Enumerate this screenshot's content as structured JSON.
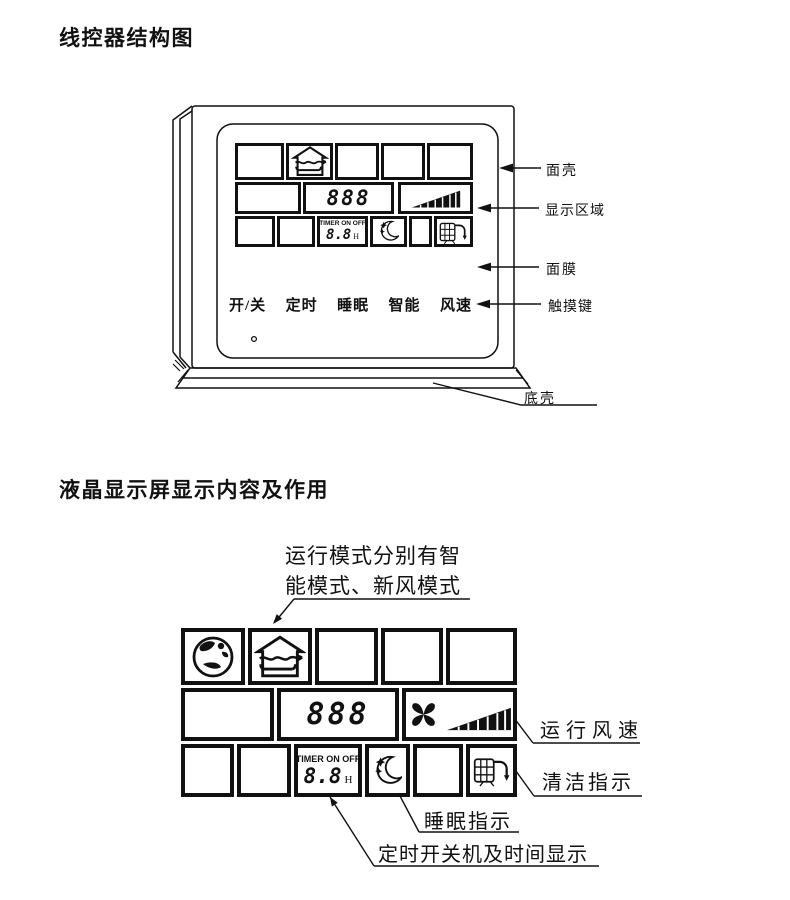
{
  "colors": {
    "ink": "#111111",
    "background": "#ffffff"
  },
  "section1": {
    "title": "线控器结构图",
    "touch_keys": [
      "开/关",
      "定时",
      "睡眠",
      "智能",
      "风速"
    ],
    "callouts": {
      "front_shell": "面壳",
      "display_area": "显示区域",
      "face_film": "面膜",
      "touch_keys": "触摸键",
      "bottom_shell": "底壳"
    },
    "display": {
      "temp_digits": "888",
      "timer_caption": "TIMER ON OFF",
      "timer_value": "8.8",
      "timer_unit": "H"
    }
  },
  "section2": {
    "title": "液晶显示屏显示内容及作用",
    "mode_note": {
      "line1": "运行模式分别有智",
      "line2": "能模式、新风模式"
    },
    "display": {
      "temp_digits": "888",
      "timer_caption": "TIMER ON OFF",
      "timer_value": "8.8",
      "timer_unit": "H"
    },
    "callouts": {
      "fan_speed": "运行风速",
      "clean": "清洁指示",
      "sleep": "睡眠指示",
      "timer": "定时开关机及时间显示"
    }
  },
  "icons": [
    "fresh-air-house-icon",
    "smart-globe-icon",
    "fan-blades-icon",
    "fan-speed-triangle-icon",
    "sleep-moon-icon",
    "clean-filter-icon"
  ]
}
